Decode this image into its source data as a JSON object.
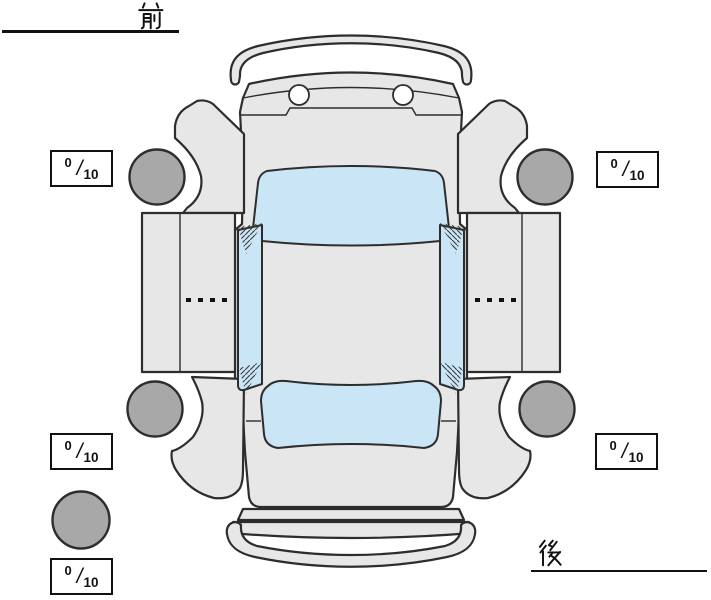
{
  "labels": {
    "front": "前",
    "rear": "後"
  },
  "tire_scores": {
    "separator": "/",
    "front_left": {
      "value": "0",
      "max": "10"
    },
    "front_right": {
      "value": "0",
      "max": "10"
    },
    "rear_left": {
      "value": "0",
      "max": "10"
    },
    "rear_right": {
      "value": "0",
      "max": "10"
    },
    "spare": {
      "value": "0",
      "max": "10"
    }
  },
  "colors": {
    "background": "#ffffff",
    "body": "#e7e7e7",
    "window": "#c9e5f6",
    "tire": "#a8a8a8",
    "outline": "#2d2d2d",
    "text": "#111111"
  }
}
